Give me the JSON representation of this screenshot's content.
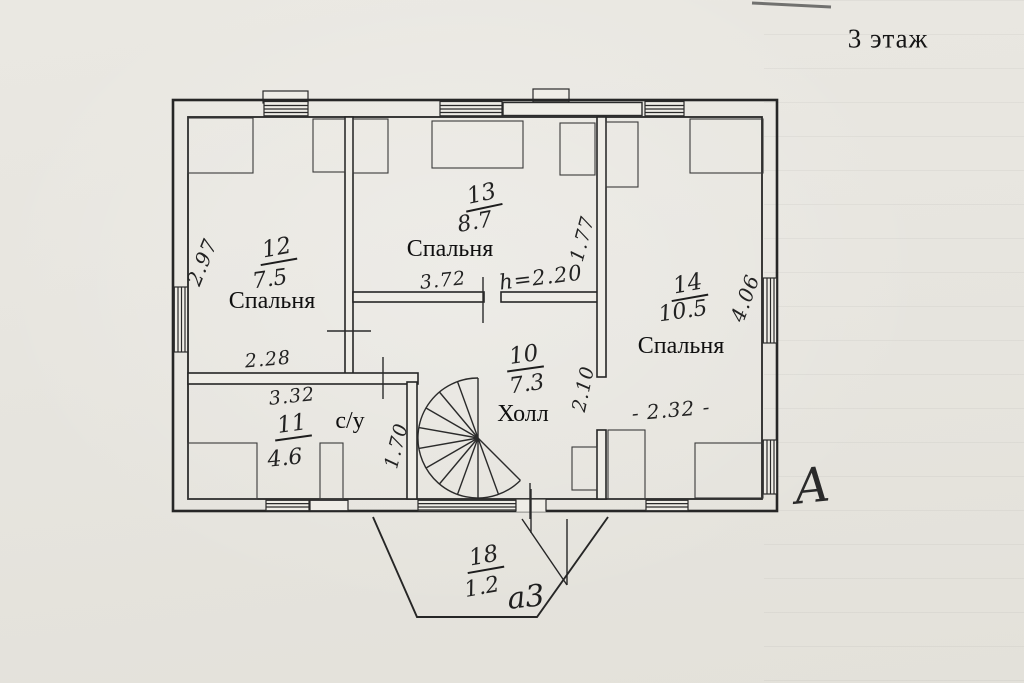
{
  "title": "3 этаж",
  "plan": {
    "rooms": {
      "r12": {
        "number": "12",
        "area": "7.5",
        "label": "Спальня"
      },
      "r13": {
        "number": "13",
        "area": "8.7",
        "label": "Спальня"
      },
      "r14": {
        "number": "14",
        "area": "10.5",
        "label": "Спальня"
      },
      "r10": {
        "number": "10",
        "area": "7.3",
        "label": "Холл"
      },
      "r11": {
        "number": "11",
        "area": "4.6",
        "label": "с/у"
      },
      "r18": {
        "number": "18",
        "area": "1.2"
      }
    },
    "dimensions": {
      "left_wall_depth": "2.97",
      "room12_width": "2.28",
      "room11_width": "3.32",
      "room13_width": "3.72",
      "ceiling_height": "h=2.20",
      "room13_side": "1.77",
      "room14_depth": "4.06",
      "room14_width": "- 2.32 -",
      "hall_side": "2.10",
      "room11_side": "1.70"
    },
    "marks": {
      "axis": "А",
      "balcony": "а3"
    }
  },
  "colors": {
    "paper": "#e8e5df",
    "ink": "#2b2b2b"
  }
}
